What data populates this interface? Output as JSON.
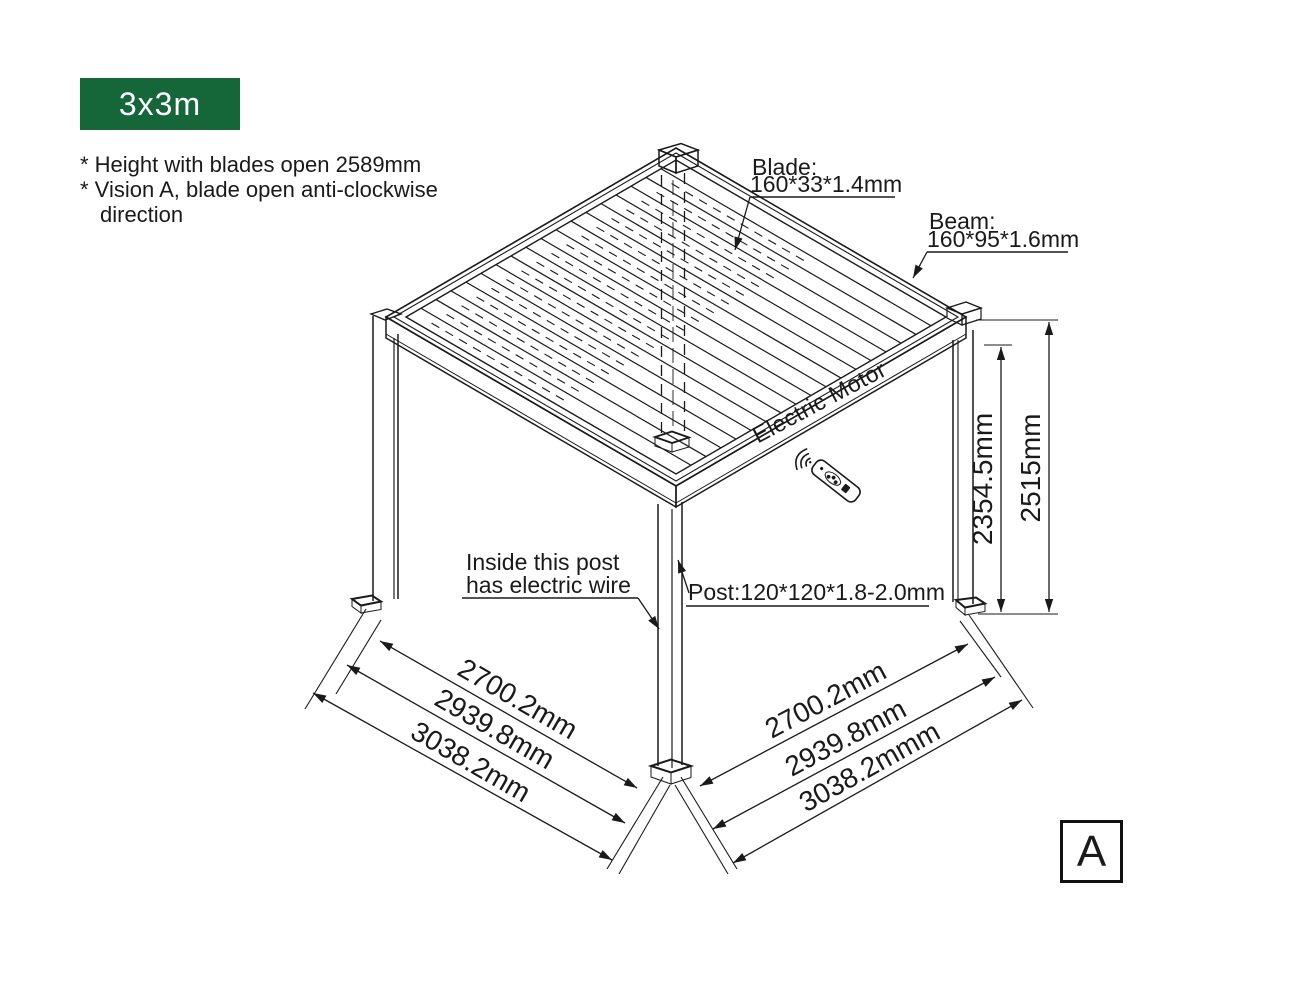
{
  "badge": {
    "label": "3x3m"
  },
  "notes": {
    "line1": "* Height with blades open 2589mm",
    "line2": "* Vision A, blade open anti-clockwise",
    "line3": "direction"
  },
  "callouts": {
    "blade_title": "Blade:",
    "blade_spec": "160*33*1.4mm",
    "beam_title": "Beam:",
    "beam_spec": "160*95*1.6mm",
    "post_spec": "Post:120*120*1.8-2.0mm",
    "inside_post_line1": "Inside this post",
    "inside_post_line2": "has electric wire",
    "motor_label": "Electric Motor"
  },
  "dimensions": {
    "height_to_beam": "2354.5mm",
    "height_overall": "2515mm",
    "left_span_inner": "2700.2mm",
    "left_span_mid": "2939.8mm",
    "left_span_outer": "3038.2mm",
    "right_span_inner": "2700.2mm",
    "right_span_mid": "2939.8mm",
    "right_span_outer": "3038.2mmm"
  },
  "view": {
    "letter": "A"
  },
  "icons": {
    "remote": "remote-control-icon",
    "signal": "wifi-signal-icon"
  },
  "colors": {
    "badge_bg": "#15673A",
    "badge_text": "#FFFFFF",
    "line": "#1A1A1A"
  }
}
